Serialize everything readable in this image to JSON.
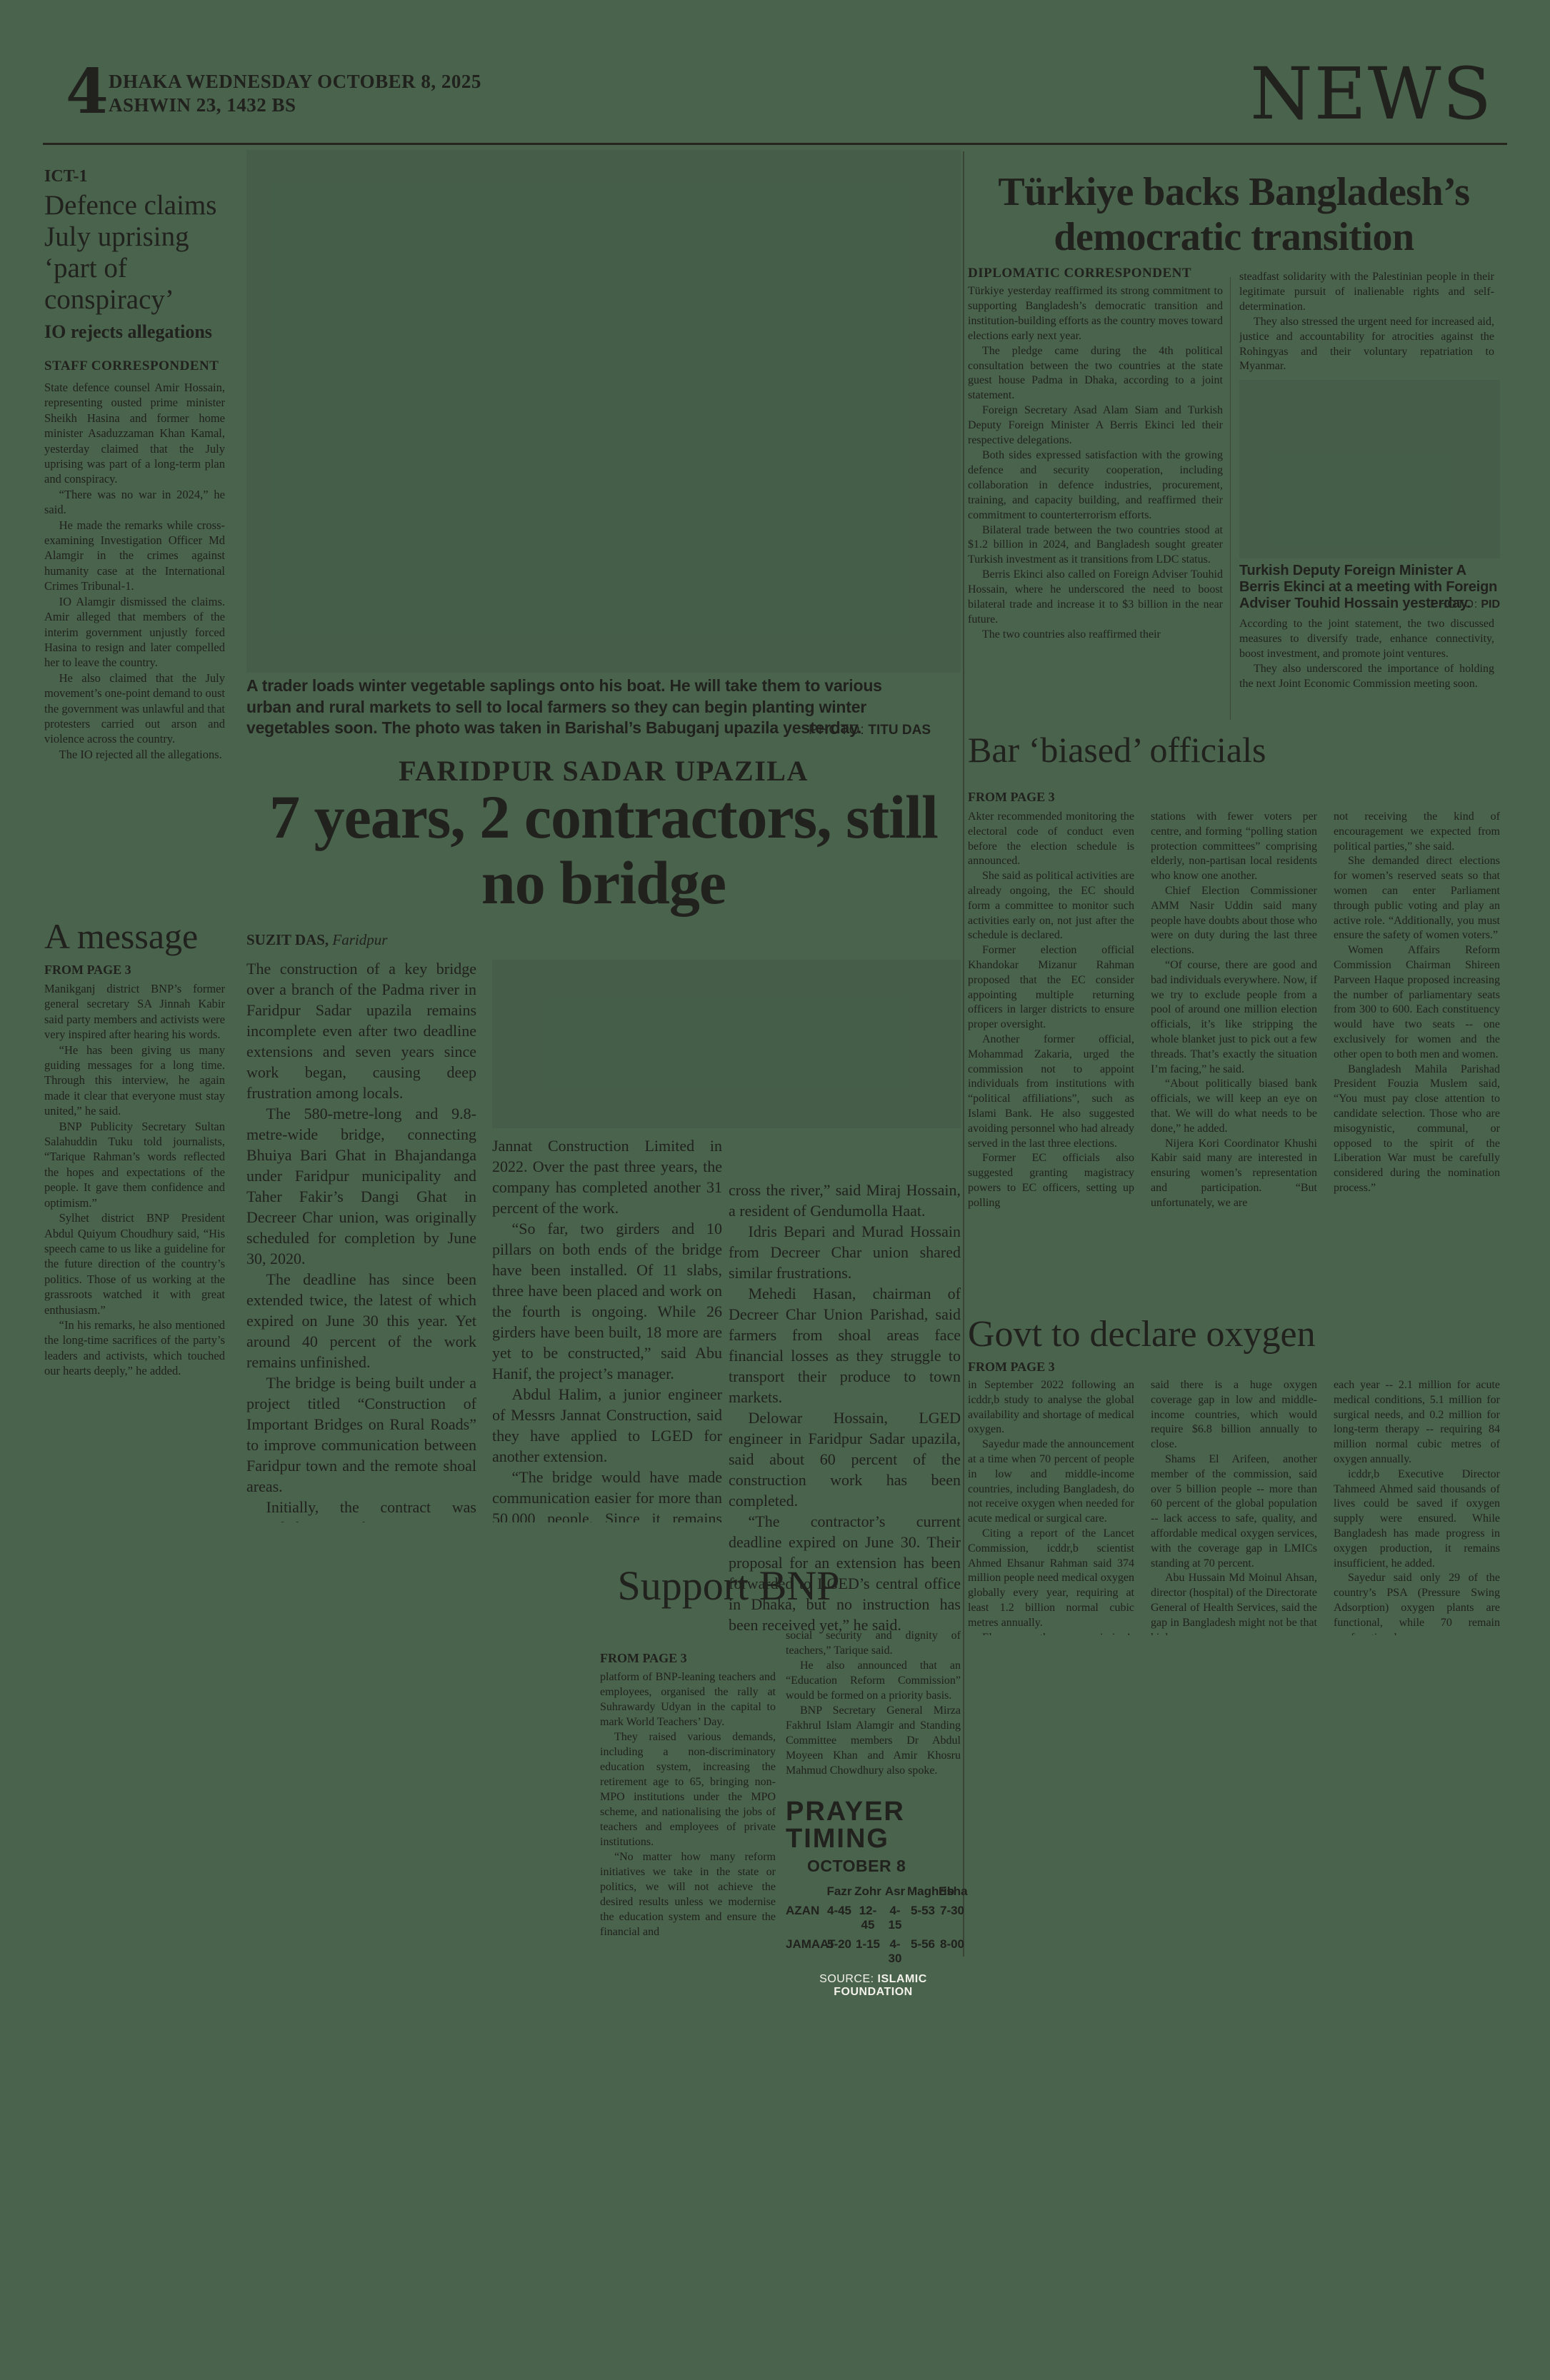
{
  "page": {
    "number": "4",
    "date_line": "DHAKA WEDNESDAY OCTOBER 8, 2025",
    "calendar_line": "ASHWIN 23, 1432 BS",
    "section": "NEWS"
  },
  "ict": {
    "kicker": "ICT-1",
    "headline": "Defence claims July uprising ‘part of conspiracy’",
    "deck": "IO rejects allegations",
    "byline": "STAFF CORRESPONDENT",
    "paragraphs": [
      "State defence counsel Amir Hossain, representing ousted prime minister Sheikh Hasina and former home minister Asaduzzaman Khan Kamal, yesterday claimed that the July uprising was part of a long-term plan and conspiracy.",
      "“There was no war in 2024,” he said.",
      "He made the remarks while cross-examining Investigation Officer Md Alamgir in the crimes against humanity case at the International Crimes Tribunal-1.",
      "IO Alamgir dismissed the claims. Amir alleged that members of the interim government unjustly forced Hasina to resign and later compelled her to leave the country.",
      "He also claimed that the July movement’s one-point demand to oust the government was unlawful and that protesters carried out arson and violence across the country.",
      "The IO rejected all the allegations."
    ]
  },
  "message": {
    "headline": "A message",
    "kicker": "FROM PAGE 3",
    "paragraphs": [
      "Manikganj district BNP’s former general secretary SA Jinnah Kabir said party members and activists were very inspired after hearing his words.",
      "“He has been giving us many guiding messages for a long time. Through this interview, he again made it clear that everyone must stay united,” he said.",
      "BNP Publicity Secretary Sultan Salahuddin Tuku told journalists, “Tarique Rahman’s words reflected the hopes and expectations of the people. It gave them confidence and optimism.”",
      "Sylhet district BNP President Abdul Quiyum Choudhury said, “His speech came to us like a guideline for the future direction of the country’s politics. Those of us working at the grassroots watched it with great enthusiasm.”",
      "“In his remarks, he also mentioned the long-time sacrifices of the party’s leaders and activists, which touched our hearts deeply,” he added."
    ]
  },
  "bridge": {
    "photo_caption": "A trader loads winter vegetable saplings onto his boat. He will take them to various urban and rural markets to sell to local farmers so they can begin planting winter vegetables soon. The photo was taken in Barishal’s Babuganj upazila yesterday.",
    "photo_credit_label": "PHOTO:",
    "photo_credit": "TITU DAS",
    "kicker": "FARIDPUR SADAR UPAZILA",
    "headline": "7 years, 2 contractors, still no bridge",
    "byline_name": "SUZIT DAS,",
    "byline_place": " Faridpur",
    "col1": [
      "The construction of a key bridge over a branch of the Padma river in Faridpur Sadar upazila remains incomplete even after two deadline extensions and seven years since work began, causing deep frustration among locals.",
      "The 580-metre-long and 9.8-metre-wide bridge, connecting Bhuiya Bari Ghat in Bhajandanga under Faridpur municipality and Taher Fakir’s Dangi Ghat in Decreer Char union, was originally scheduled for completion by June 30, 2020.",
      "The deadline has since been extended twice, the latest of which expired on June 30 this year. Yet around 40 percent of the work remains unfinished.",
      "The bridge is being built under a project titled “Construction of Important Bridges on Rural Roads” to improve communication between Faridpur town and the remote shoal areas.",
      "Initially, the contract was awarded to Rafia Construction. However, its owners were arrested in 2020 as prime accused in a Tk 2,500 crore money laundering case and several others, and have been in jail since. The project came to a halt that year, with only 29 percent work completed.",
      "After a two-year pause, the contract was re-awarded to Messrs"
    ],
    "col2": [
      "Jannat Construction Limited in 2022. Over the past three years, the company has completed another 31 percent of the work.",
      "“So far, two girders and 10 pillars on both ends of the bridge have been installed. Of 11 slabs, three have been placed and work on the fourth is ongoing. While 26 girders have been built, 18 more are yet to be constructed,” said Abu Hanif, the project’s manager.",
      "Abdul Halim, a junior engineer of Messrs Jannat Construction, said they have applied to LGED for another extension.",
      "“The bridge would have made communication easier for more than 50,000 people. Since it remains unfinished, we still have to use trawlers and engine-boats to"
    ],
    "col3": [
      "cross the river,” said Miraj Hossain, a resident of Gendumolla Haat.",
      "Idris Bepari and Murad Hossain from Decreer Char union shared similar frustrations.",
      "Mehedi Hasan, chairman of Decreer Char Union Parishad, said farmers from shoal areas face financial losses as they struggle to transport their produce to town markets.",
      "Delowar Hossain, LGED engineer in Faridpur Sadar upazila, said about 60 percent of the construction work has been completed.",
      "“The contractor’s current deadline expired on June 30. Their proposal for an extension has been forwarded to LGED’s central office in Dhaka, but no instruction has been received yet,” he said."
    ]
  },
  "turkiye": {
    "headline": "Türkiye backs Bangladesh’s democratic transition",
    "byline": "DIPLOMATIC CORRESPONDENT",
    "col1": [
      "Türkiye yesterday reaffirmed its strong commitment to supporting Bangladesh’s democratic transition and institution-building efforts as the country moves toward elections early next year.",
      "The pledge came during the 4th political consultation between the two countries at the state guest house Padma in Dhaka, according to a joint statement.",
      "Foreign Secretary Asad Alam Siam and Turkish Deputy Foreign Minister A Berris Ekinci led their respective delegations.",
      "Both sides expressed satisfaction with the growing defence and security cooperation, including collaboration in defence industries, procurement, training, and capacity building, and reaffirmed their commitment to counterterrorism efforts.",
      "Bilateral trade between the two countries stood at $1.2 billion in 2024, and Bangladesh sought greater Turkish investment as it transitions from LDC status.",
      "Berris Ekinci also called on Foreign Adviser Touhid Hossain, where he underscored the need to boost bilateral trade and increase it to $3 billion in the near future.",
      "The two countries also reaffirmed their"
    ],
    "col2_top": [
      "steadfast solidarity with the Palestinian people in their legitimate pursuit of inalienable rights and self-determination.",
      "They also stressed the urgent need for increased aid, justice and accountability for atrocities against the Rohingyas and their voluntary repatriation to Myanmar."
    ],
    "photo_caption": "Turkish Deputy Foreign Minister A Berris Ekinci at a meeting with Foreign Adviser Touhid Hossain yesterday.",
    "photo_credit_label": "PHOTO:",
    "photo_credit": "PID",
    "col2_bottom": [
      "According to the joint statement, the two discussed measures to diversify trade, enhance connectivity, boost investment, and promote joint ventures.",
      "They also underscored the importance of holding the next Joint Economic Commission meeting soon."
    ]
  },
  "bar": {
    "headline": "Bar ‘biased’ officials",
    "kicker": "FROM PAGE 3",
    "col1": [
      "Akter recommended monitoring the electoral code of conduct even before the election schedule is announced.",
      "She said as political activities are already ongoing, the EC should form a committee to monitor such activities early on, not just after the schedule is declared.",
      "Former election official Khandokar Mizanur Rahman proposed that the EC consider appointing multiple returning officers in larger districts to ensure proper oversight.",
      "Another former official, Mohammad Zakaria, urged the commission not to appoint individuals from institutions with “political affiliations”, such as Islami Bank. He also suggested avoiding personnel who had already served in the last three elections.",
      "Former EC officials also suggested granting magistracy powers to EC officers, setting up polling"
    ],
    "col2": [
      "stations with fewer voters per centre, and forming “polling station protection committees” comprising elderly, non-partisan local residents who know one another.",
      "Chief Election Commissioner AMM Nasir Uddin said many people have doubts about those who were on duty during the last three elections.",
      "“Of course, there are good and bad individuals everywhere. Now, if we try to exclude people from a pool of around one million election officials, it’s like stripping the whole blanket just to pick out a few threads. That’s exactly the situation I’m facing,” he said.",
      "“About politically biased bank officials, we will keep an eye on that. We will do what needs to be done,” he added.",
      "Nijera Kori Coordinator Khushi Kabir said many are interested in ensuring women’s representation and participation. “But unfortunately, we are"
    ],
    "col3": [
      "not receiving the kind of encouragement we expected from political parties,” she said.",
      "She demanded direct elections for women’s reserved seats so that women can enter Parliament through public voting and play an active role. “Additionally, you must ensure the safety of women voters.”",
      "Women Affairs Reform Commission Chairman Shireen Parveen Haque proposed increasing the number of parliamentary seats from 300 to 600. Each constituency would have two seats -- one exclusively for women and the other open to both men and women.",
      "Bangladesh Mahila Parishad President Fouzia Muslem said, “You must pay close attention to candidate selection. Those who are misogynistic, communal, or opposed to the spirit of the Liberation War must be carefully considered during the nomination process.”"
    ]
  },
  "oxygen": {
    "headline": "Govt to declare oxygen",
    "kicker": "FROM PAGE 3",
    "col1": [
      "in September 2022 following an icddr,b study to analyse the global availability and shortage of medical oxygen.",
      "Sayedur made the announcement at a time when 70 percent of people in low and middle-income countries, including Bangladesh, do not receive oxygen when needed for acute medical or surgical care.",
      "Citing a report of the Lancet Commission, icddr,b scientist Ahmed Ehsanur Rahman said 374 million people need medical oxygen globally every year, requiring at least 1.2 billion normal cubic metres annually.",
      "Ehsanur, the commission’s executive committee member and an author of the report,"
    ],
    "col2": [
      "said there is a huge oxygen coverage gap in low and middle-income countries, which would require $6.8 billion annually to close.",
      "Shams El Arifeen, another member of the commission, said over 5 billion people -- more than 60 percent of the global population -- lack access to safe, quality, and affordable medical oxygen services, with the coverage gap in LMICs standing at 70 percent.",
      "Abu Hussain Md Moinul Ahsan, director (hospital) of the Directorate General of Health Services, said the gap in Bangladesh might not be that high.",
      "It was shared at the summit that about 7.4 million people in Bangladesh need oxygen"
    ],
    "col3": [
      "each year -- 2.1 million for acute medical conditions, 5.1 million for surgical needs, and 0.2 million for long-term therapy -- requiring 84 million normal cubic metres of oxygen annually.",
      "icddr,b Executive Director Tahmeed Ahmed said thousands of lives could be saved if oxygen supply were ensured. While Bangladesh has made progress in oxygen production, it remains insufficient, he added.",
      "Sayedur said only 29 of the country’s PSA (Pressure Swing Adsorption) oxygen plants are functional, while 70 remain nonfunctional.",
      "The government plans to launch a new project to make all plants operational and develop an integrated oxygen network, he added."
    ]
  },
  "bnp": {
    "headline": "Support BNP",
    "kicker": "FROM PAGE 3",
    "col1": [
      "platform of BNP-leaning teachers and employees, organised the rally at Suhrawardy Udyan in the capital to mark World Teachers’ Day.",
      "They raised various demands, including a non-discriminatory education system, increasing the retirement age to 65, bringing non-MPO institutions under the MPO scheme, and nationalising the jobs of teachers and employees of private institutions.",
      "“No matter how many reform initiatives we take in the state or politics, we will not achieve the desired results unless we modernise the education system and ensure the financial and"
    ],
    "col2": [
      "social security and dignity of teachers,” Tarique said.",
      "He also announced that an “Education Reform Commission” would be formed on a priority basis.",
      "BNP Secretary General Mirza Fakhrul Islam Alamgir and Standing Committee members Dr Abdul Moyeen Khan and Amir Khosru Mahmud Chowdhury also spoke."
    ]
  },
  "prayer": {
    "title_line1": "PRAYER",
    "title_line2": "TIMING",
    "date": "OCTOBER 8",
    "columns": [
      "Fazr",
      "Zohr",
      "Asr",
      "Maghrib",
      "Esha"
    ],
    "rows": [
      {
        "label": "AZAN",
        "times": [
          "4-45",
          "12-45",
          "4-15",
          "5-53",
          "7-30"
        ]
      },
      {
        "label": "JAMAAT",
        "times": [
          "5-20",
          "1-15",
          "4-30",
          "5-56",
          "8-00"
        ]
      }
    ],
    "source_label": "SOURCE:",
    "source": "ISLAMIC FOUNDATION"
  }
}
